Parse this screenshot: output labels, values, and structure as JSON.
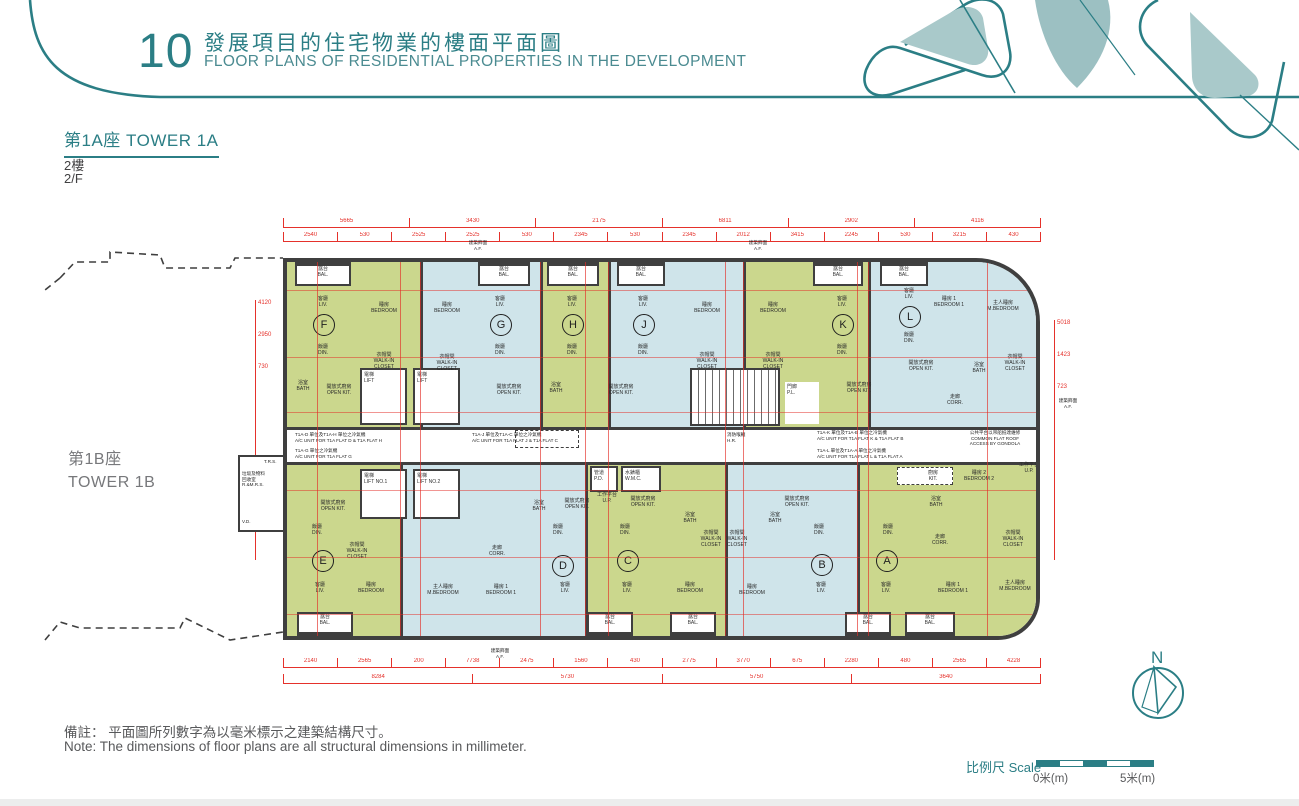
{
  "header": {
    "number": "10",
    "title_zh": "發展項目的住宅物業的樓面平面圖",
    "title_en": "FLOOR PLANS OF RESIDENTIAL PROPERTIES IN THE DEVELOPMENT"
  },
  "tower": {
    "name_zh": "第1A座",
    "name_en": "TOWER 1A",
    "floor_zh": "2樓",
    "floor_en": "2/F"
  },
  "adjacent_tower": {
    "name_zh": "第1B座",
    "name_en": "TOWER 1B"
  },
  "notes": {
    "zh": "備註： 平面圖所列數字為以毫米標示之建築結構尺寸。",
    "en": "Note:  The dimensions of floor plans are all structural dimensions in millimeter."
  },
  "scale_bar": {
    "label_zh": "比例尺",
    "label_en": "Scale",
    "zero": "0米(m)",
    "five": "5米(m)"
  },
  "compass": {
    "label": "N"
  },
  "colors": {
    "accent_teal": "#2b7e85",
    "unit_green": "#cbd78d",
    "unit_blue": "#cfe4ea",
    "wall": "#3f3f3f",
    "dimension_red": "#e5312b"
  },
  "units": {
    "top": [
      {
        "id": "F",
        "color": "green"
      },
      {
        "id": "G",
        "color": "blue"
      },
      {
        "id": "H",
        "color": "green"
      },
      {
        "id": "J",
        "color": "blue"
      },
      {
        "id": "K",
        "color": "green"
      },
      {
        "id": "L",
        "color": "blue"
      }
    ],
    "bottom": [
      {
        "id": "E",
        "color": "green"
      },
      {
        "id": "D",
        "color": "blue"
      },
      {
        "id": "C",
        "color": "green"
      },
      {
        "id": "B",
        "color": "blue"
      },
      {
        "id": "A",
        "color": "green"
      }
    ]
  },
  "rooms": {
    "liv": "客廳\nLIV.",
    "din": "飯廳\nDIN.",
    "bal": "露台\nBAL.",
    "bed": "睡房\nBEDROOM",
    "bed1": "睡房 1\nBEDROOM 1",
    "bed2": "睡房 2\nBEDROOM 2",
    "mbed": "主人睡房\nM.BEDROOM",
    "wic": "衣帽間\nWALK-IN\nCLOSET",
    "bath": "浴室\nBATH",
    "okit": "開放式廚房\nOPEN KIT.",
    "kit": "廚房\nKIT.",
    "corr": "走廊\nCORR.",
    "lift": "電梯\nLIFT",
    "lift_no1": "NO.1",
    "lift_no2": "NO.2",
    "up": "工作平台\nU.P.",
    "pd": "管道\nP.D.",
    "wmc": "水錶櫃\nW.M.C.",
    "hr": "消防喉轆\nH.R.",
    "pl": "門廊\nP.L.",
    "trs": "T.R.S.",
    "rmrs": "垃圾及物料\n回收室\nR.&M.R.S.",
    "vd": "V.D."
  },
  "annotations": {
    "af": "建築飾面\nA.F.",
    "gondola": "公共平台以吊船抵達維修\nCOMMON FLAT ROOF\nACCESS BY GONDOLA",
    "ac_dh": "T1A-D 單位及T1A-H 單位之冷氣機\nA/C UNIT FOR T1A FLAT D & T1A FLAT H",
    "ac_g": "T1A-G 單位之冷氣機\nA/C UNIT FOR T1A FLAT G",
    "ac_jc": "T1A-J 單位及T1A-C 單位之冷氣機\nA/C UNIT FOR T1A FLAT J & T1A FLAT C",
    "ac_kb": "T1A-K 單位及T1A-B 單位之冷氣機\nA/C UNIT FOR T1A FLAT K & T1A FLAT B",
    "ac_la": "T1A-L 單位及T1A-A 單位之冷氣機\nA/C UNIT FOR T1A FLAT L & T1A FLAT A"
  },
  "dims": {
    "top1": [
      "5665",
      "3430",
      "2175",
      "6811",
      "2902",
      "4116"
    ],
    "top2": [
      "2540",
      "530",
      "2525",
      "2525",
      "530",
      "2345",
      "530",
      "2345",
      "2012",
      "3415",
      "2245",
      "530",
      "3215",
      "430"
    ],
    "bottom1": [
      "2140",
      "2565",
      "200",
      "7738",
      "2475",
      "1560",
      "430",
      "2775",
      "3770",
      "675",
      "2280",
      "480",
      "2565",
      "4228"
    ],
    "bottom2": [
      "8284",
      "5730",
      "5750",
      "3640"
    ],
    "left": [
      "4120",
      "2950",
      "730"
    ],
    "right": [
      "5018",
      "1423",
      "723"
    ]
  }
}
